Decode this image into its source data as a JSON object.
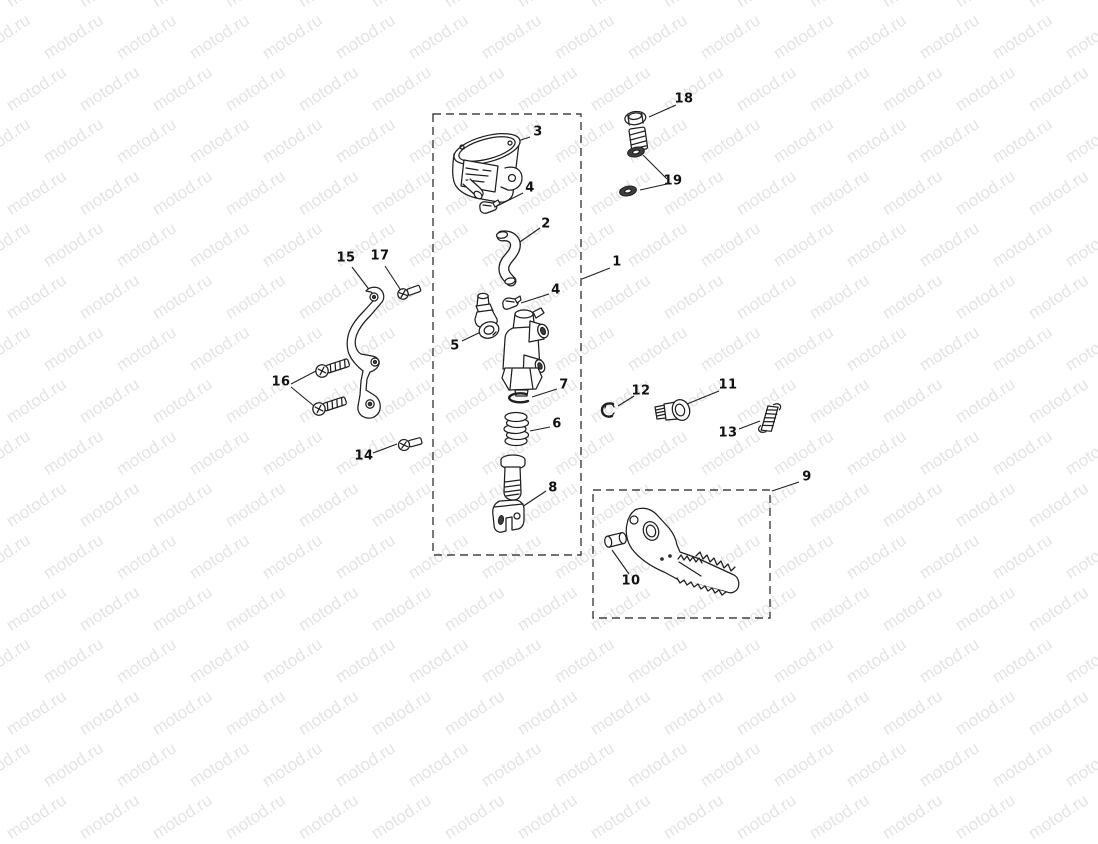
{
  "page": {
    "background_color": "#ffffff"
  },
  "watermark": {
    "text": "motod.ru",
    "color": "#e4e4e4"
  },
  "diagram": {
    "type": "exploded-parts-diagram",
    "callouts": [
      "1",
      "2",
      "3",
      "4",
      "4",
      "5",
      "6",
      "7",
      "8",
      "9",
      "10",
      "11",
      "12",
      "13",
      "14",
      "15",
      "16",
      "17",
      "18",
      "19"
    ]
  }
}
